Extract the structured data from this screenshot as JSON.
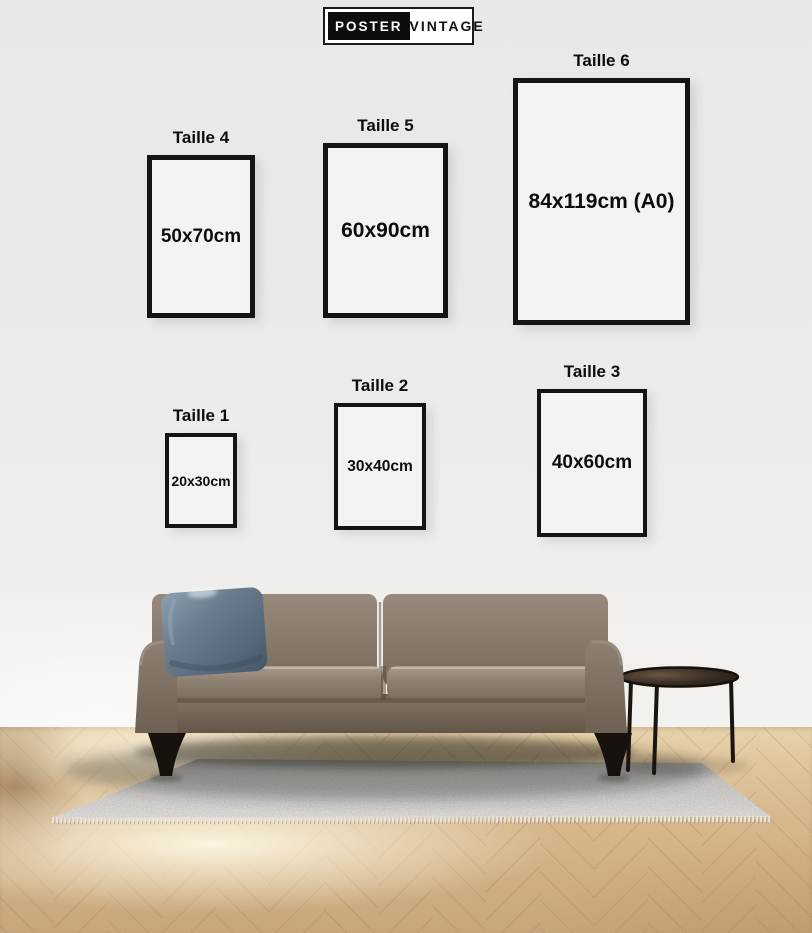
{
  "brand": {
    "primary": "POSTER",
    "secondary": "VINTAGE"
  },
  "size_guide": {
    "frames": [
      {
        "id": "taille-4",
        "label": "Taille 4",
        "dimensions": "50x70cm"
      },
      {
        "id": "taille-5",
        "label": "Taille 5",
        "dimensions": "60x90cm"
      },
      {
        "id": "taille-6",
        "label": "Taille 6",
        "dimensions": "84x119cm (A0)"
      },
      {
        "id": "taille-1",
        "label": "Taille 1",
        "dimensions": "20x30cm"
      },
      {
        "id": "taille-2",
        "label": "Taille 2",
        "dimensions": "30x40cm"
      },
      {
        "id": "taille-3",
        "label": "Taille 3",
        "dimensions": "40x60cm"
      }
    ]
  },
  "colors": {
    "wall": "#ecebea",
    "ink": "#0d0d0d",
    "frame-border": "#141414",
    "frame-face": "#f4f3f2",
    "logo-bg": "#0d0d0d",
    "logo-ink": "#111111",
    "logo-face": "#ffffff",
    "floor-wood": "#d7b68c",
    "floor-line": "#8a6340",
    "rug": "#d6d5d2",
    "sofa": "#87796b",
    "sofa-dark": "#6b5e50",
    "pillow": "#64788a",
    "table": "#2e251d"
  }
}
